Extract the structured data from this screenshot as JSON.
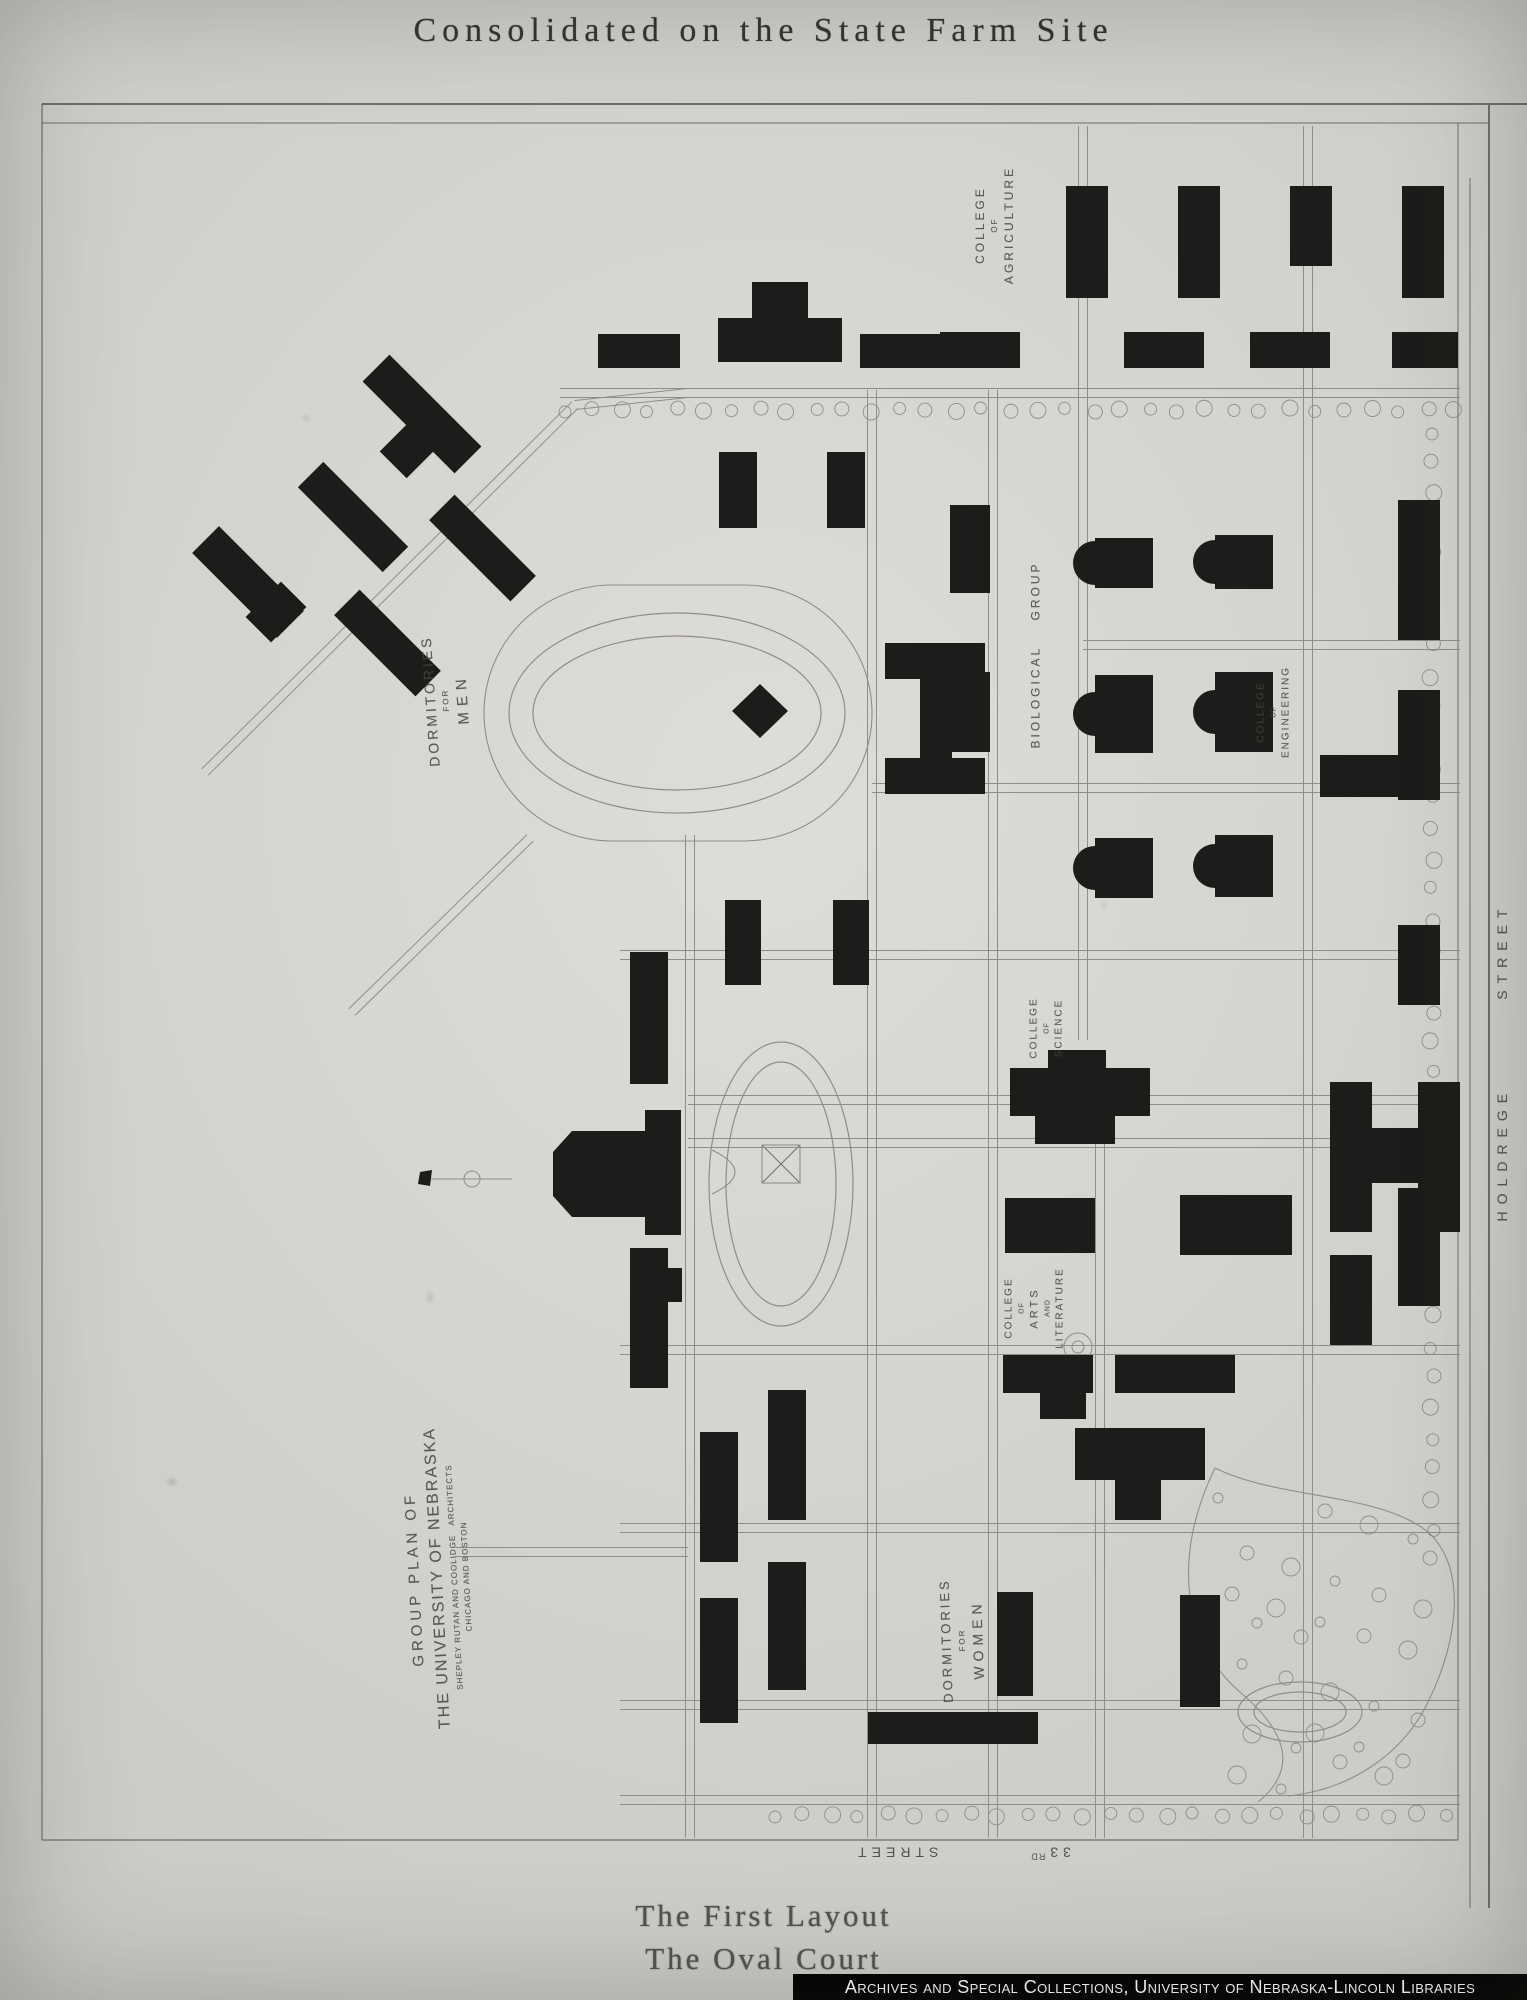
{
  "title": "Consolidated on the State Farm Site",
  "captions": {
    "line1": "The First Layout",
    "line2": "The Oval Court"
  },
  "credit": "Archives and Special Collections, University of Nebraska-Lincoln Libraries",
  "plan": {
    "street_33rd": {
      "number": "33",
      "ordinal": "RD",
      "word": "STREET"
    },
    "colors": {
      "paper": "#d6d5d1",
      "ink": "#8f8e85",
      "border": "#6f6f67",
      "building": "#1c1c1a",
      "label": "#45443d",
      "credit_bg": "#000000",
      "credit_fg": "#ffffff"
    },
    "labels": [
      {
        "id": "label-college-of-agriculture",
        "x": 995,
        "y": 225,
        "rot": -90,
        "lines": [
          "COLLEGE",
          "OF",
          "AGRICULTURE"
        ],
        "sizes": [
          12,
          8,
          12
        ],
        "sp": [
          3,
          2,
          3
        ]
      },
      {
        "id": "label-dormitories-for-men",
        "x": 447,
        "y": 700,
        "rot": -94,
        "lines": [
          "DORMITORIES",
          "FOR",
          "MEN"
        ],
        "sizes": [
          14,
          8,
          15
        ],
        "sp": [
          3,
          2,
          6
        ]
      },
      {
        "id": "label-biological-group",
        "x": 1036,
        "y": 655,
        "rot": -90,
        "lines": [
          "BIOLOGICAL    GROUP"
        ],
        "sizes": [
          12
        ],
        "sp": [
          3
        ]
      },
      {
        "id": "label-college-of-engineering",
        "x": 1274,
        "y": 712,
        "rot": -90,
        "lines": [
          "COLLEGE",
          "OF",
          "ENGINEERING"
        ],
        "sizes": [
          10,
          7,
          10
        ],
        "sp": [
          2,
          1,
          2
        ]
      },
      {
        "id": "label-college-of-science",
        "x": 1047,
        "y": 1028,
        "rot": -90,
        "lines": [
          "COLLEGE",
          "OF",
          "SCIENCE"
        ],
        "sizes": [
          10,
          7,
          10
        ],
        "sp": [
          2,
          1,
          2
        ]
      },
      {
        "id": "label-college-of-arts-and-literature",
        "x": 1035,
        "y": 1308,
        "rot": -90,
        "lines": [
          "COLLEGE",
          "OF",
          "ARTS",
          "AND",
          "LITERATURE"
        ],
        "sizes": [
          10,
          7,
          11,
          7,
          10
        ],
        "sp": [
          2,
          1,
          3,
          1,
          2
        ]
      },
      {
        "id": "label-dormitories-for-women",
        "x": 963,
        "y": 1640,
        "rot": -92,
        "lines": [
          "DORMITORIES",
          "FOR",
          "WOMEN"
        ],
        "sizes": [
          13,
          8,
          14
        ],
        "sp": [
          3,
          2,
          5
        ]
      },
      {
        "id": "label-group-plan-title-block",
        "x": 438,
        "y": 1578,
        "rot": -93,
        "lines": [
          "GROUP PLAN OF",
          "THE UNIVERSITY OF NEBRASKA",
          "SHEPLEY RUTAN AND COOLIDGE   ARCHITECTS",
          "CHICAGO AND BOSTON"
        ],
        "sizes": [
          15,
          16,
          8,
          8
        ],
        "sp": [
          4,
          2,
          1,
          1
        ]
      },
      {
        "id": "label-holdrege-street",
        "x": 1502,
        "y": 1062,
        "rot": -90,
        "lines": [
          "HOLDREGE        STREET"
        ],
        "sizes": [
          14
        ],
        "sp": [
          7
        ]
      }
    ],
    "geometry": {
      "singles": [
        [
          42,
          104,
          1527,
          104,
          2
        ],
        [
          42,
          123,
          1489,
          123,
          1
        ],
        [
          42,
          104,
          42,
          1840,
          1.2
        ],
        [
          42,
          1840,
          1458,
          1840,
          1.2
        ],
        [
          1458,
          123,
          1458,
          1840,
          1
        ],
        [
          1470,
          178,
          1470,
          1908,
          1
        ],
        [
          1489,
          104,
          1489,
          1908,
          2
        ],
        [
          762,
          1145,
          800,
          1183,
          1
        ],
        [
          800,
          1145,
          762,
          1183,
          1
        ]
      ],
      "streets": [
        [
          560,
          393,
          1460,
          393
        ],
        [
          872,
          390,
          872,
          1838
        ],
        [
          993,
          390,
          993,
          1838
        ],
        [
          1083,
          126,
          1083,
          1040
        ],
        [
          1100,
          1143,
          1100,
          1838
        ],
        [
          1308,
          126,
          1308,
          1838
        ],
        [
          690,
          835,
          690,
          1838
        ],
        [
          1083,
          645,
          1460,
          645
        ],
        [
          872,
          788,
          1460,
          788
        ],
        [
          620,
          955,
          1460,
          955
        ],
        [
          688,
          1100,
          1460,
          1100
        ],
        [
          688,
          1143,
          1460,
          1143
        ],
        [
          620,
          1350,
          1460,
          1350
        ],
        [
          620,
          1528,
          1460,
          1528
        ],
        [
          620,
          1705,
          1460,
          1705
        ],
        [
          620,
          1800,
          1460,
          1800
        ],
        [
          455,
          1552,
          688,
          1552
        ],
        [
          205,
          772,
          575,
          405
        ],
        [
          575,
          405,
          688,
          393
        ],
        [
          352,
          1012,
          530,
          838
        ]
      ],
      "outlineRects": [
        [
          484,
          585,
          388,
          256,
          128
        ],
        [
          762,
          1145,
          38,
          38,
          0
        ]
      ],
      "ellipses": [
        [
          677,
          713,
          168,
          100
        ],
        [
          677,
          713,
          144,
          77
        ],
        [
          781,
          1184,
          72,
          142
        ],
        [
          781,
          1184,
          55,
          122
        ],
        [
          1300,
          1712,
          62,
          30
        ],
        [
          1300,
          1712,
          46,
          20
        ]
      ],
      "circlesOutline": [
        [
          1078,
          1347,
          14
        ],
        [
          1078,
          1347,
          6
        ],
        [
          472,
          1179,
          8
        ]
      ],
      "paths": [
        "M712,1150 Q758,1172 712,1194",
        "M1215,1468 C1170,1560 1185,1645 1240,1692 C1292,1736 1295,1772 1258,1802",
        "M1215,1468 C1280,1500 1378,1492 1428,1532 C1468,1568 1458,1642 1428,1702 C1402,1756 1348,1790 1288,1796",
        "M430,1179 L512,1179"
      ],
      "buildings": [
        [
          1066,
          186,
          42,
          112
        ],
        [
          1178,
          186,
          42,
          112
        ],
        [
          1290,
          186,
          42,
          80
        ],
        [
          1402,
          186,
          42,
          112
        ],
        [
          940,
          332,
          80,
          36
        ],
        [
          1124,
          332,
          80,
          36
        ],
        [
          1250,
          332,
          80,
          36
        ],
        [
          1392,
          332,
          66,
          36
        ],
        [
          718,
          318,
          124,
          44
        ],
        [
          752,
          282,
          56,
          38
        ],
        [
          598,
          334,
          82,
          34
        ],
        [
          860,
          334,
          82,
          34
        ],
        [
          719,
          452,
          38,
          76
        ],
        [
          827,
          452,
          38,
          76
        ],
        [
          950,
          505,
          40,
          88
        ],
        [
          950,
          672,
          40,
          80
        ],
        [
          1398,
          500,
          42,
          140
        ],
        [
          1398,
          690,
          42,
          110
        ],
        [
          1320,
          755,
          120,
          42
        ],
        [
          1398,
          925,
          42,
          80
        ],
        [
          885,
          643,
          100,
          36
        ],
        [
          885,
          758,
          100,
          36
        ],
        [
          920,
          679,
          32,
          79
        ],
        [
          725,
          900,
          36,
          85
        ],
        [
          833,
          900,
          36,
          85
        ],
        [
          1010,
          1068,
          140,
          48
        ],
        [
          1048,
          1050,
          58,
          18
        ],
        [
          1035,
          1116,
          80,
          28
        ],
        [
          630,
          952,
          38,
          132
        ],
        [
          630,
          1248,
          38,
          140
        ],
        [
          700,
          1432,
          38,
          130
        ],
        [
          700,
          1598,
          38,
          125
        ],
        [
          768,
          1390,
          38,
          130
        ],
        [
          768,
          1562,
          38,
          128
        ],
        [
          645,
          1110,
          36,
          125
        ],
        [
          648,
          1268,
          34,
          34
        ],
        [
          1005,
          1198,
          90,
          55
        ],
        [
          1180,
          1195,
          112,
          60
        ],
        [
          1003,
          1355,
          90,
          38
        ],
        [
          1115,
          1355,
          120,
          38
        ],
        [
          1040,
          1393,
          46,
          26
        ],
        [
          1330,
          1255,
          42,
          90
        ],
        [
          1398,
          1188,
          42,
          118
        ],
        [
          1330,
          1082,
          42,
          150
        ],
        [
          1418,
          1082,
          42,
          150
        ],
        [
          1360,
          1128,
          70,
          55
        ],
        [
          1075,
          1428,
          130,
          52
        ],
        [
          1115,
          1480,
          46,
          40
        ],
        [
          997,
          1592,
          36,
          104
        ],
        [
          868,
          1712,
          170,
          32
        ],
        [
          1180,
          1595,
          40,
          112
        ],
        [
          1095,
          538,
          58,
          50
        ],
        [
          1215,
          535,
          58,
          54
        ],
        [
          1095,
          675,
          58,
          78
        ],
        [
          1215,
          672,
          58,
          80
        ],
        [
          1095,
          838,
          58,
          60
        ],
        [
          1215,
          835,
          58,
          62
        ],
        [
          357,
          395,
          130,
          38,
          45
        ],
        [
          394,
          417,
          38,
          56,
          45
        ],
        [
          293,
          499,
          120,
          36,
          45
        ],
        [
          188,
          563,
          120,
          38,
          45
        ],
        [
          258,
          587,
          36,
          50,
          45
        ],
        [
          425,
          530,
          115,
          36,
          45
        ],
        [
          330,
          625,
          115,
          36,
          45
        ]
      ],
      "apses": [
        [
          1095,
          563,
          22
        ],
        [
          1215,
          562,
          22
        ],
        [
          1095,
          714,
          22
        ],
        [
          1215,
          712,
          22
        ],
        [
          1095,
          868,
          22
        ],
        [
          1215,
          866,
          22
        ]
      ],
      "polygons": [
        [
          [
            553,
            1152
          ],
          [
            572,
            1131
          ],
          [
            648,
            1131
          ],
          [
            648,
            1217
          ],
          [
            572,
            1217
          ],
          [
            553,
            1196
          ]
        ],
        [
          [
            760,
            684
          ],
          [
            788,
            711
          ],
          [
            760,
            738
          ],
          [
            732,
            711
          ]
        ],
        [
          [
            420,
            1172
          ],
          [
            432,
            1170
          ],
          [
            430,
            1186
          ],
          [
            418,
            1184
          ]
        ]
      ],
      "treeRows": [
        [
          565,
          410,
          1455,
          410,
          27,
          6
        ],
        [
          1432,
          432,
          1432,
          1560,
          30,
          6
        ],
        [
          775,
          1815,
          1445,
          1815,
          27,
          6
        ]
      ],
      "parkTrees": {
        "count": 30,
        "x0": 1218,
        "xm": 210,
        "y0": 1498,
        "ym": 292
      }
    }
  }
}
